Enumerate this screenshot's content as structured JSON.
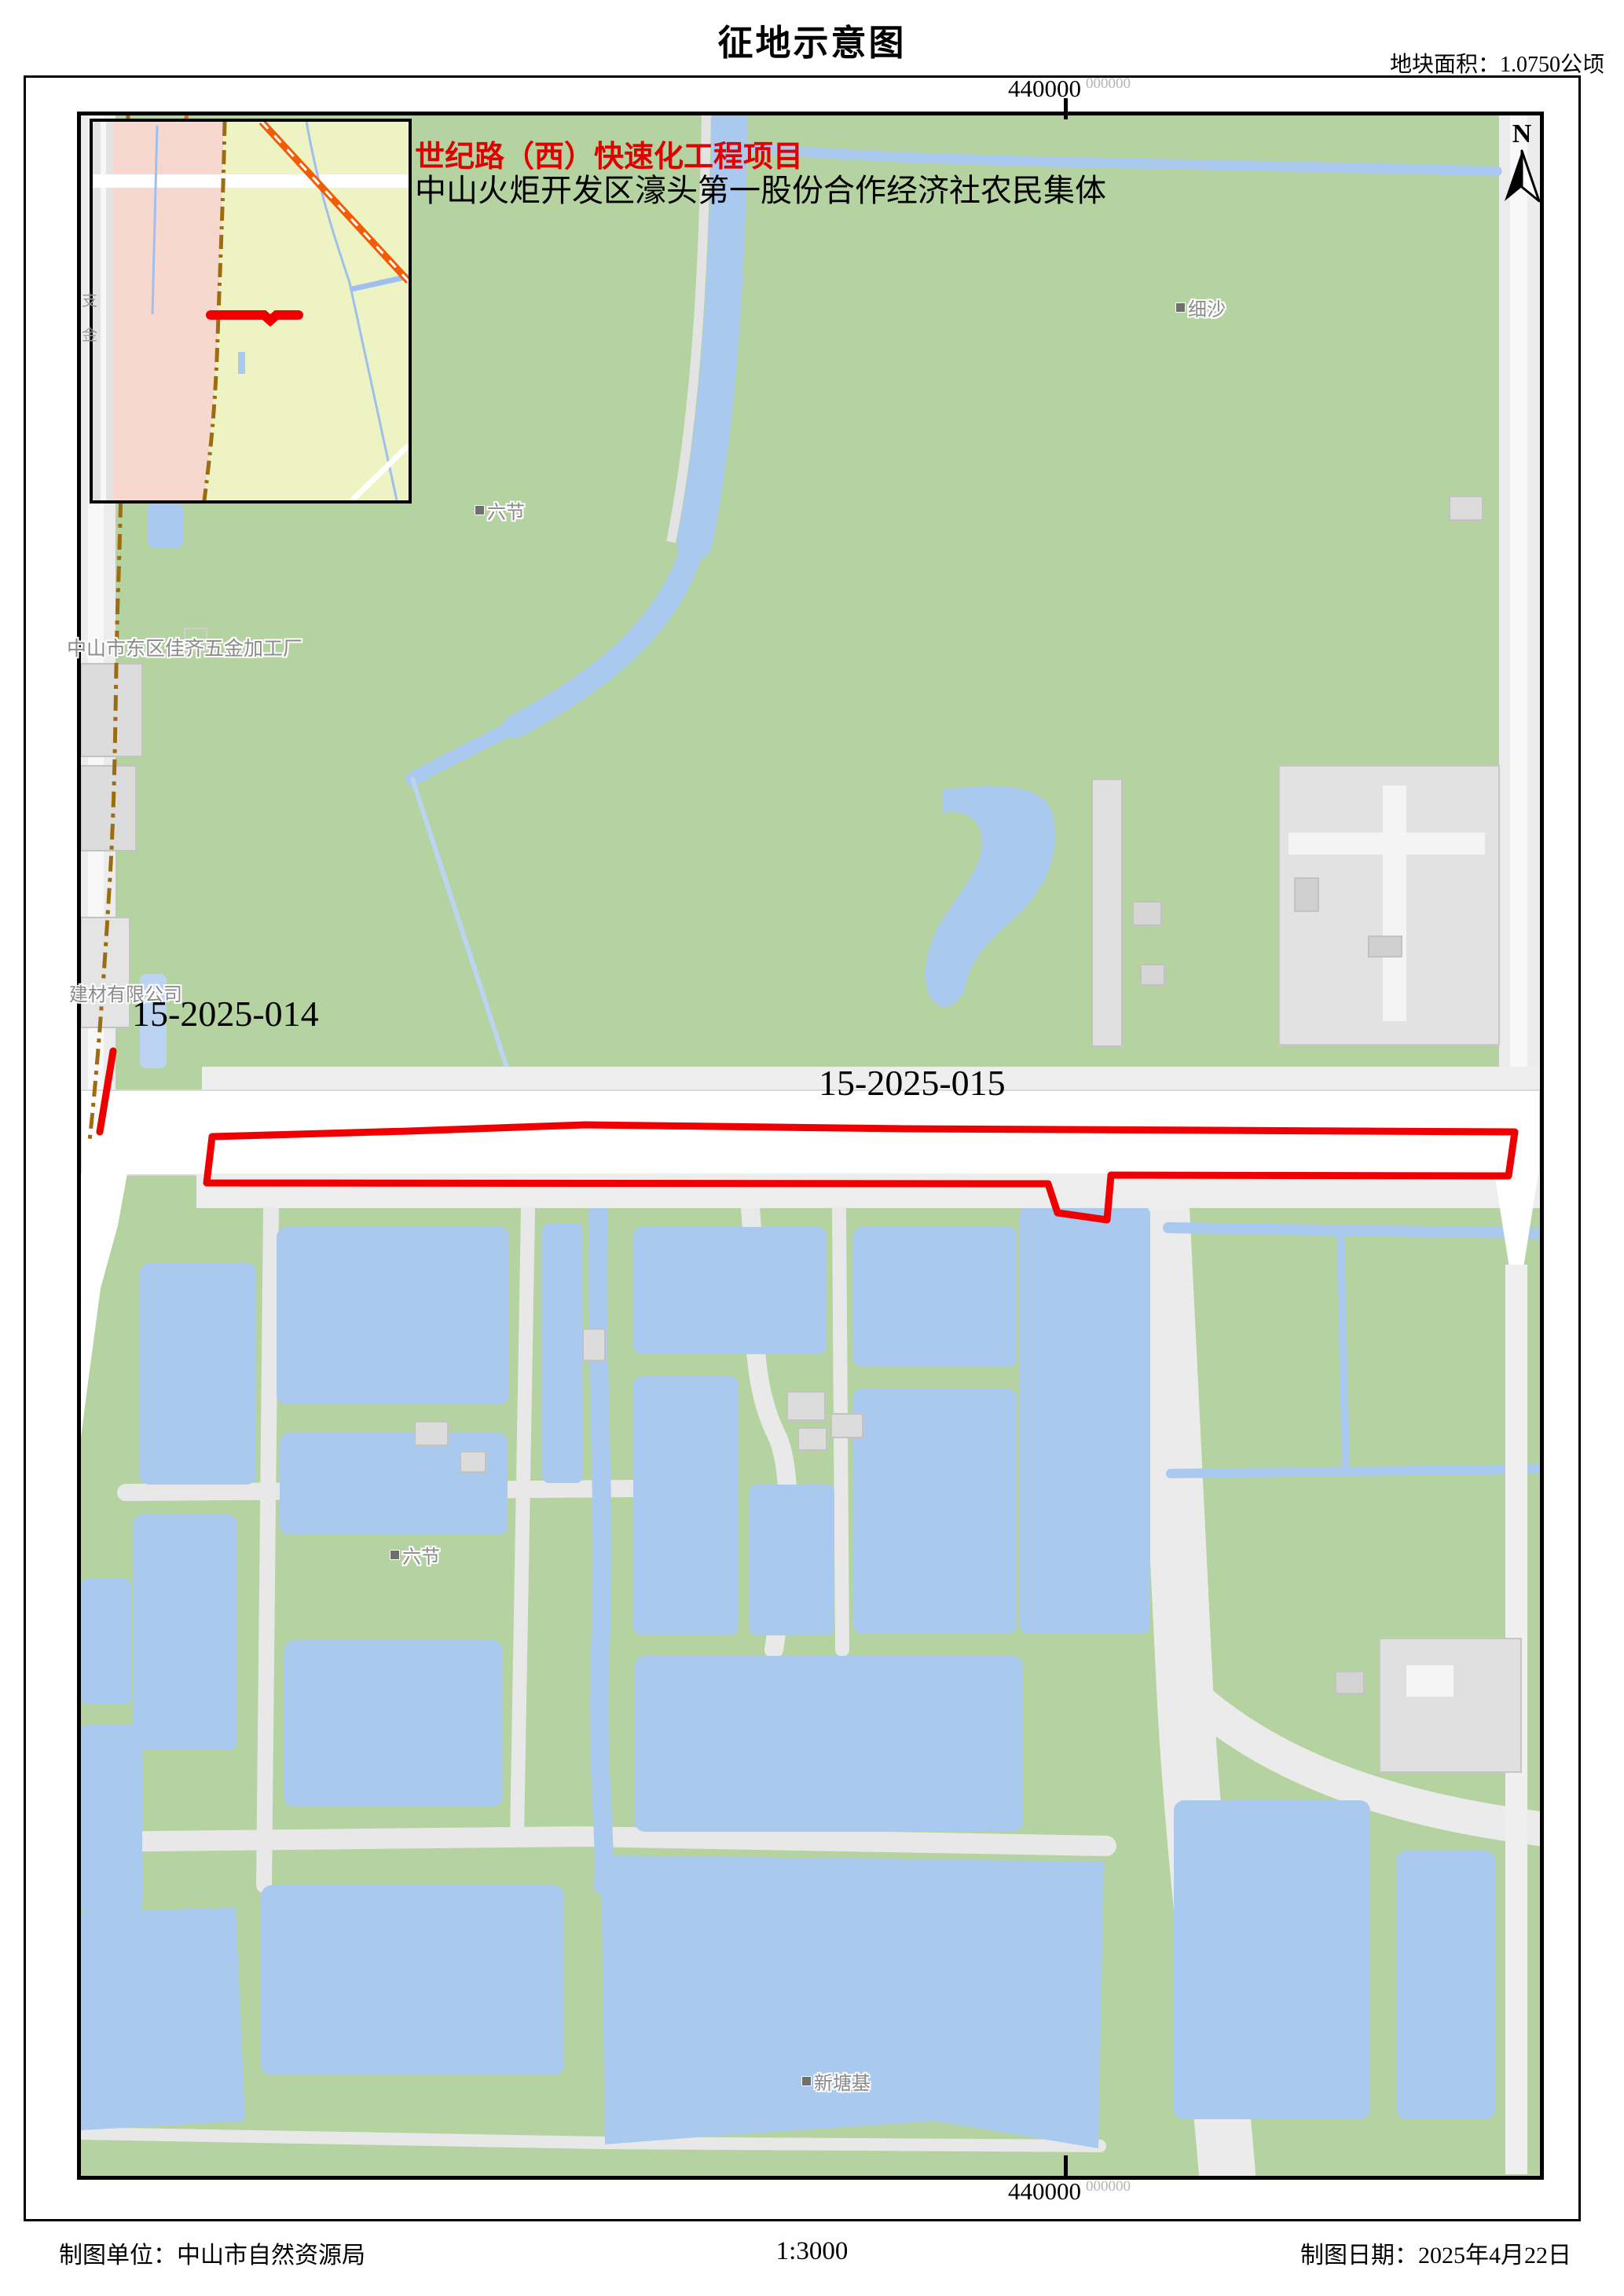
{
  "title": "征地示意图",
  "area_note": "地块面积：1.0750公顷",
  "project": {
    "name_line1": "世纪路（西）快速化工程项目",
    "name_line2": "中山火炬开发区濠头第一股份合作经济社农民集体"
  },
  "parcels": [
    {
      "id": "15-2025-014"
    },
    {
      "id": "15-2025-015"
    }
  ],
  "coordinates": {
    "top_main": "440000",
    "top_sup": "000000",
    "bottom_main": "440000",
    "bottom_sup": "000000"
  },
  "north_label": "N",
  "place_labels": {
    "xisha": "细沙",
    "liujie_1": "六节",
    "liujie_2": "六节",
    "factory": "中山市东区佳齐五金加工厂",
    "building_materials": "建材有限公司",
    "xintangji": "新塘基",
    "inset_side_1": "支",
    "inset_side_2": "金"
  },
  "footer": {
    "agency": "制图单位：中山市自然资源局",
    "scale": "1:3000",
    "date": "制图日期：2025年4月22日"
  },
  "colors": {
    "land_green": "#b4d3a0",
    "water_blue": "#a9c9ef",
    "parcel_red": "#ee0000",
    "inset_pink": "#f7d8cf",
    "inset_green": "#eef3c4",
    "boundary_brown": "#9c6d10",
    "railway_orange": "#f25c05",
    "road_white": "#ffffff",
    "building_gray": "#dcdcdc",
    "label_gray": "#8a8a8a"
  }
}
